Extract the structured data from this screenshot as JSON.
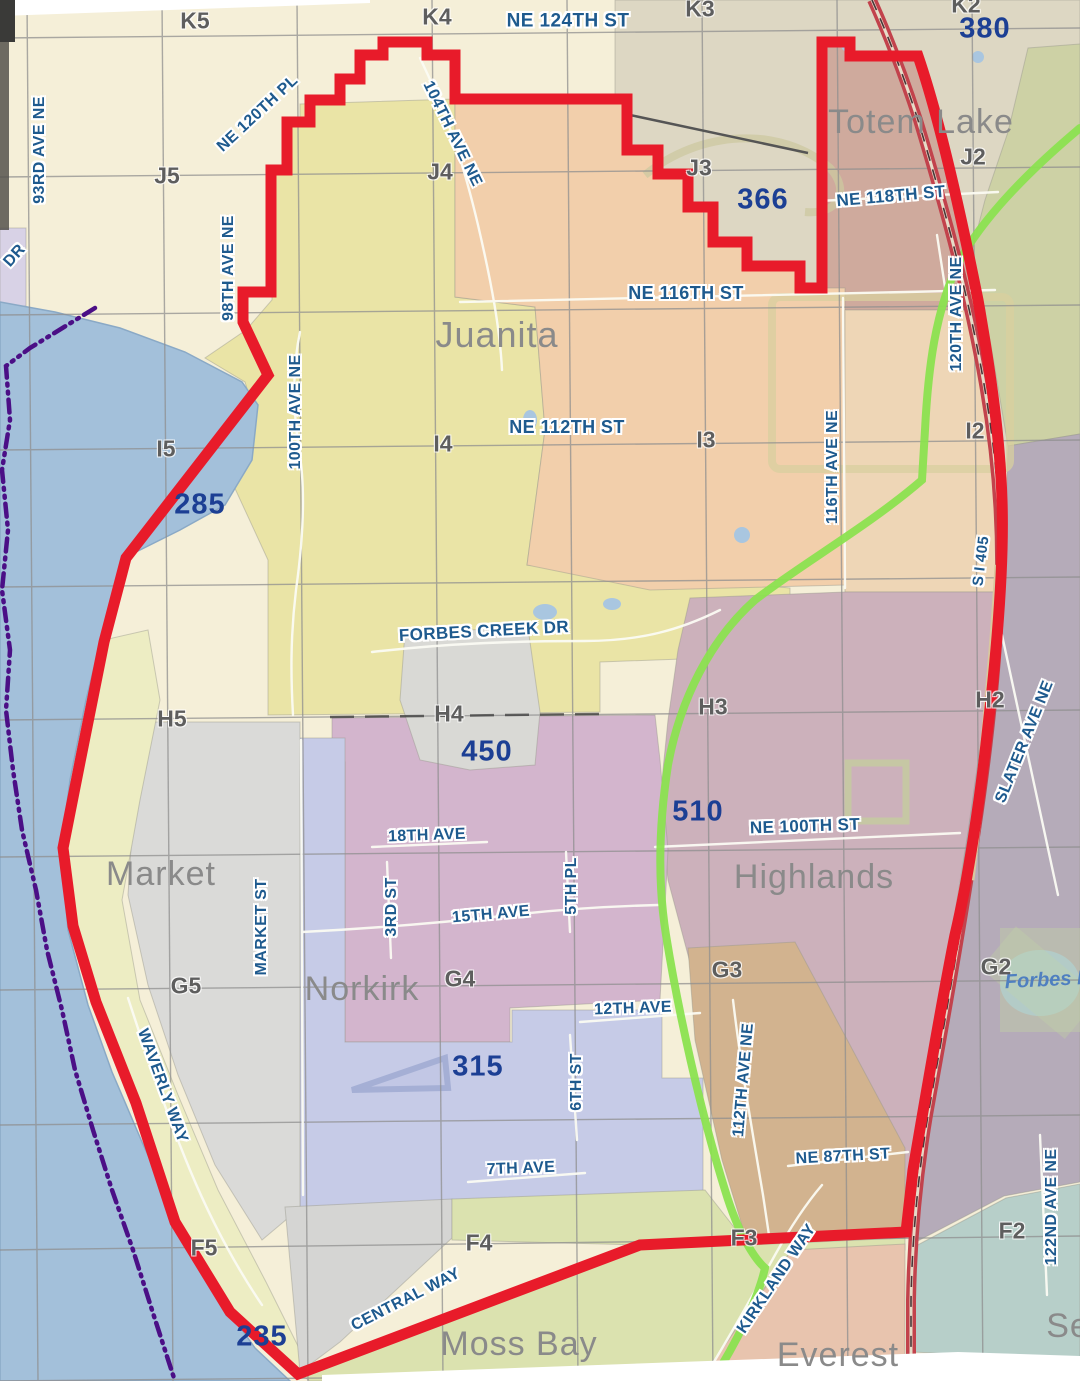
{
  "map": {
    "description": "City neighborhood map with red study-area boundary",
    "accent_boundary_color": "#e81b2a",
    "trail_color": "#8be150",
    "freeway_color": "#c2424c",
    "city_limit_dash_color": "#4b0f86",
    "water_color": "#a3c0da"
  },
  "labels": {
    "streets": [
      {
        "text": "NE 124TH ST",
        "x": 568,
        "y": 21,
        "rot": 0,
        "size": 19
      },
      {
        "text": "NE 120TH PL",
        "x": 258,
        "y": 114,
        "rot": -43,
        "size": 16
      },
      {
        "text": "93RD AVE NE",
        "x": 40,
        "y": 150,
        "rot": -90,
        "size": 16
      },
      {
        "text": "DR",
        "x": 15,
        "y": 256,
        "rot": -48,
        "size": 16
      },
      {
        "text": "98TH AVE NE",
        "x": 229,
        "y": 268,
        "rot": -90,
        "size": 16
      },
      {
        "text": "104TH AVE NE",
        "x": 452,
        "y": 134,
        "rot": 64,
        "size": 16
      },
      {
        "text": "NE 118TH ST",
        "x": 891,
        "y": 196,
        "rot": -5,
        "size": 17
      },
      {
        "text": "NE 116TH ST",
        "x": 686,
        "y": 293,
        "rot": 0,
        "size": 18
      },
      {
        "text": "NE 112TH ST",
        "x": 567,
        "y": 427,
        "rot": 0,
        "size": 18
      },
      {
        "text": "100TH AVE NE",
        "x": 296,
        "y": 412,
        "rot": -90,
        "size": 16
      },
      {
        "text": "116TH AVE NE",
        "x": 833,
        "y": 467,
        "rot": -90,
        "size": 16
      },
      {
        "text": "120TH AVE NE",
        "x": 957,
        "y": 314,
        "rot": -90,
        "size": 16
      },
      {
        "text": "S I 405",
        "x": 981,
        "y": 561,
        "rot": -83,
        "size": 15
      },
      {
        "text": "SLATER AVE NE",
        "x": 1025,
        "y": 742,
        "rot": -68,
        "size": 16
      },
      {
        "text": "FORBES CREEK DR",
        "x": 484,
        "y": 631,
        "rot": -3,
        "size": 17
      },
      {
        "text": "NE 100TH ST",
        "x": 805,
        "y": 826,
        "rot": -2,
        "size": 17
      },
      {
        "text": "18TH AVE",
        "x": 427,
        "y": 836,
        "rot": -2,
        "size": 16
      },
      {
        "text": "MARKET ST",
        "x": 262,
        "y": 927,
        "rot": -90,
        "size": 16
      },
      {
        "text": "3RD ST",
        "x": 392,
        "y": 907,
        "rot": -90,
        "size": 16
      },
      {
        "text": "15TH AVE",
        "x": 491,
        "y": 915,
        "rot": -5,
        "size": 16
      },
      {
        "text": "5TH PL",
        "x": 572,
        "y": 886,
        "rot": -90,
        "size": 16
      },
      {
        "text": "12TH AVE",
        "x": 633,
        "y": 1009,
        "rot": -2,
        "size": 16
      },
      {
        "text": "6TH ST",
        "x": 577,
        "y": 1082,
        "rot": -90,
        "size": 16
      },
      {
        "text": "112TH AVE NE",
        "x": 744,
        "y": 1080,
        "rot": -85,
        "size": 16
      },
      {
        "text": "NE 87TH ST",
        "x": 843,
        "y": 1157,
        "rot": -3,
        "size": 16
      },
      {
        "text": "7TH AVE",
        "x": 521,
        "y": 1169,
        "rot": -2,
        "size": 16
      },
      {
        "text": "WAVERLY WAY",
        "x": 162,
        "y": 1086,
        "rot": 70,
        "size": 16
      },
      {
        "text": "KIRKLAND WAY",
        "x": 777,
        "y": 1279,
        "rot": -56,
        "size": 16
      },
      {
        "text": "CENTRAL WAY",
        "x": 406,
        "y": 1300,
        "rot": -27,
        "size": 16
      },
      {
        "text": "122ND AVE NE",
        "x": 1052,
        "y": 1207,
        "rot": -90,
        "size": 16
      }
    ],
    "grid": [
      {
        "text": "K5",
        "x": 195,
        "y": 21
      },
      {
        "text": "K4",
        "x": 437,
        "y": 17
      },
      {
        "text": "K3",
        "x": 700,
        "y": 9
      },
      {
        "text": "K2",
        "x": 966,
        "y": 5
      },
      {
        "text": "J5",
        "x": 167,
        "y": 176
      },
      {
        "text": "J4",
        "x": 440,
        "y": 172
      },
      {
        "text": "J3",
        "x": 699,
        "y": 168
      },
      {
        "text": "J2",
        "x": 973,
        "y": 157
      },
      {
        "text": "I5",
        "x": 166,
        "y": 449
      },
      {
        "text": "I4",
        "x": 443,
        "y": 444
      },
      {
        "text": "I3",
        "x": 706,
        "y": 440
      },
      {
        "text": "I2",
        "x": 975,
        "y": 431
      },
      {
        "text": "H5",
        "x": 172,
        "y": 719
      },
      {
        "text": "H4",
        "x": 449,
        "y": 714
      },
      {
        "text": "H3",
        "x": 713,
        "y": 707
      },
      {
        "text": "H2",
        "x": 990,
        "y": 700
      },
      {
        "text": "G5",
        "x": 186,
        "y": 986
      },
      {
        "text": "G4",
        "x": 460,
        "y": 979
      },
      {
        "text": "G3",
        "x": 727,
        "y": 970
      },
      {
        "text": "G2",
        "x": 996,
        "y": 967
      },
      {
        "text": "F5",
        "x": 204,
        "y": 1248
      },
      {
        "text": "F4",
        "x": 479,
        "y": 1243
      },
      {
        "text": "F3",
        "x": 744,
        "y": 1238
      },
      {
        "text": "F2",
        "x": 1012,
        "y": 1231
      }
    ],
    "numbers": [
      {
        "text": "380",
        "x": 985,
        "y": 29
      },
      {
        "text": "366",
        "x": 763,
        "y": 200
      },
      {
        "text": "285",
        "x": 200,
        "y": 505
      },
      {
        "text": "450",
        "x": 487,
        "y": 752
      },
      {
        "text": "510",
        "x": 698,
        "y": 812
      },
      {
        "text": "315",
        "x": 478,
        "y": 1067
      },
      {
        "text": "235",
        "x": 262,
        "y": 1337
      }
    ],
    "neighborhoods": [
      {
        "text": "Totem Lake",
        "x": 921,
        "y": 122
      },
      {
        "text": "Juanita",
        "x": 497,
        "y": 335,
        "size": 36
      },
      {
        "text": "Market",
        "x": 161,
        "y": 874
      },
      {
        "text": "Norkirk",
        "x": 362,
        "y": 989
      },
      {
        "text": "Highlands",
        "x": 814,
        "y": 877
      },
      {
        "text": "Moss Bay",
        "x": 519,
        "y": 1344
      },
      {
        "text": "Everest",
        "x": 838,
        "y": 1355
      },
      {
        "text": "Se",
        "x": 1068,
        "y": 1326
      }
    ],
    "water_features": [
      {
        "text": "Forbes L",
        "x": 1047,
        "y": 980,
        "rot": -3
      }
    ]
  }
}
